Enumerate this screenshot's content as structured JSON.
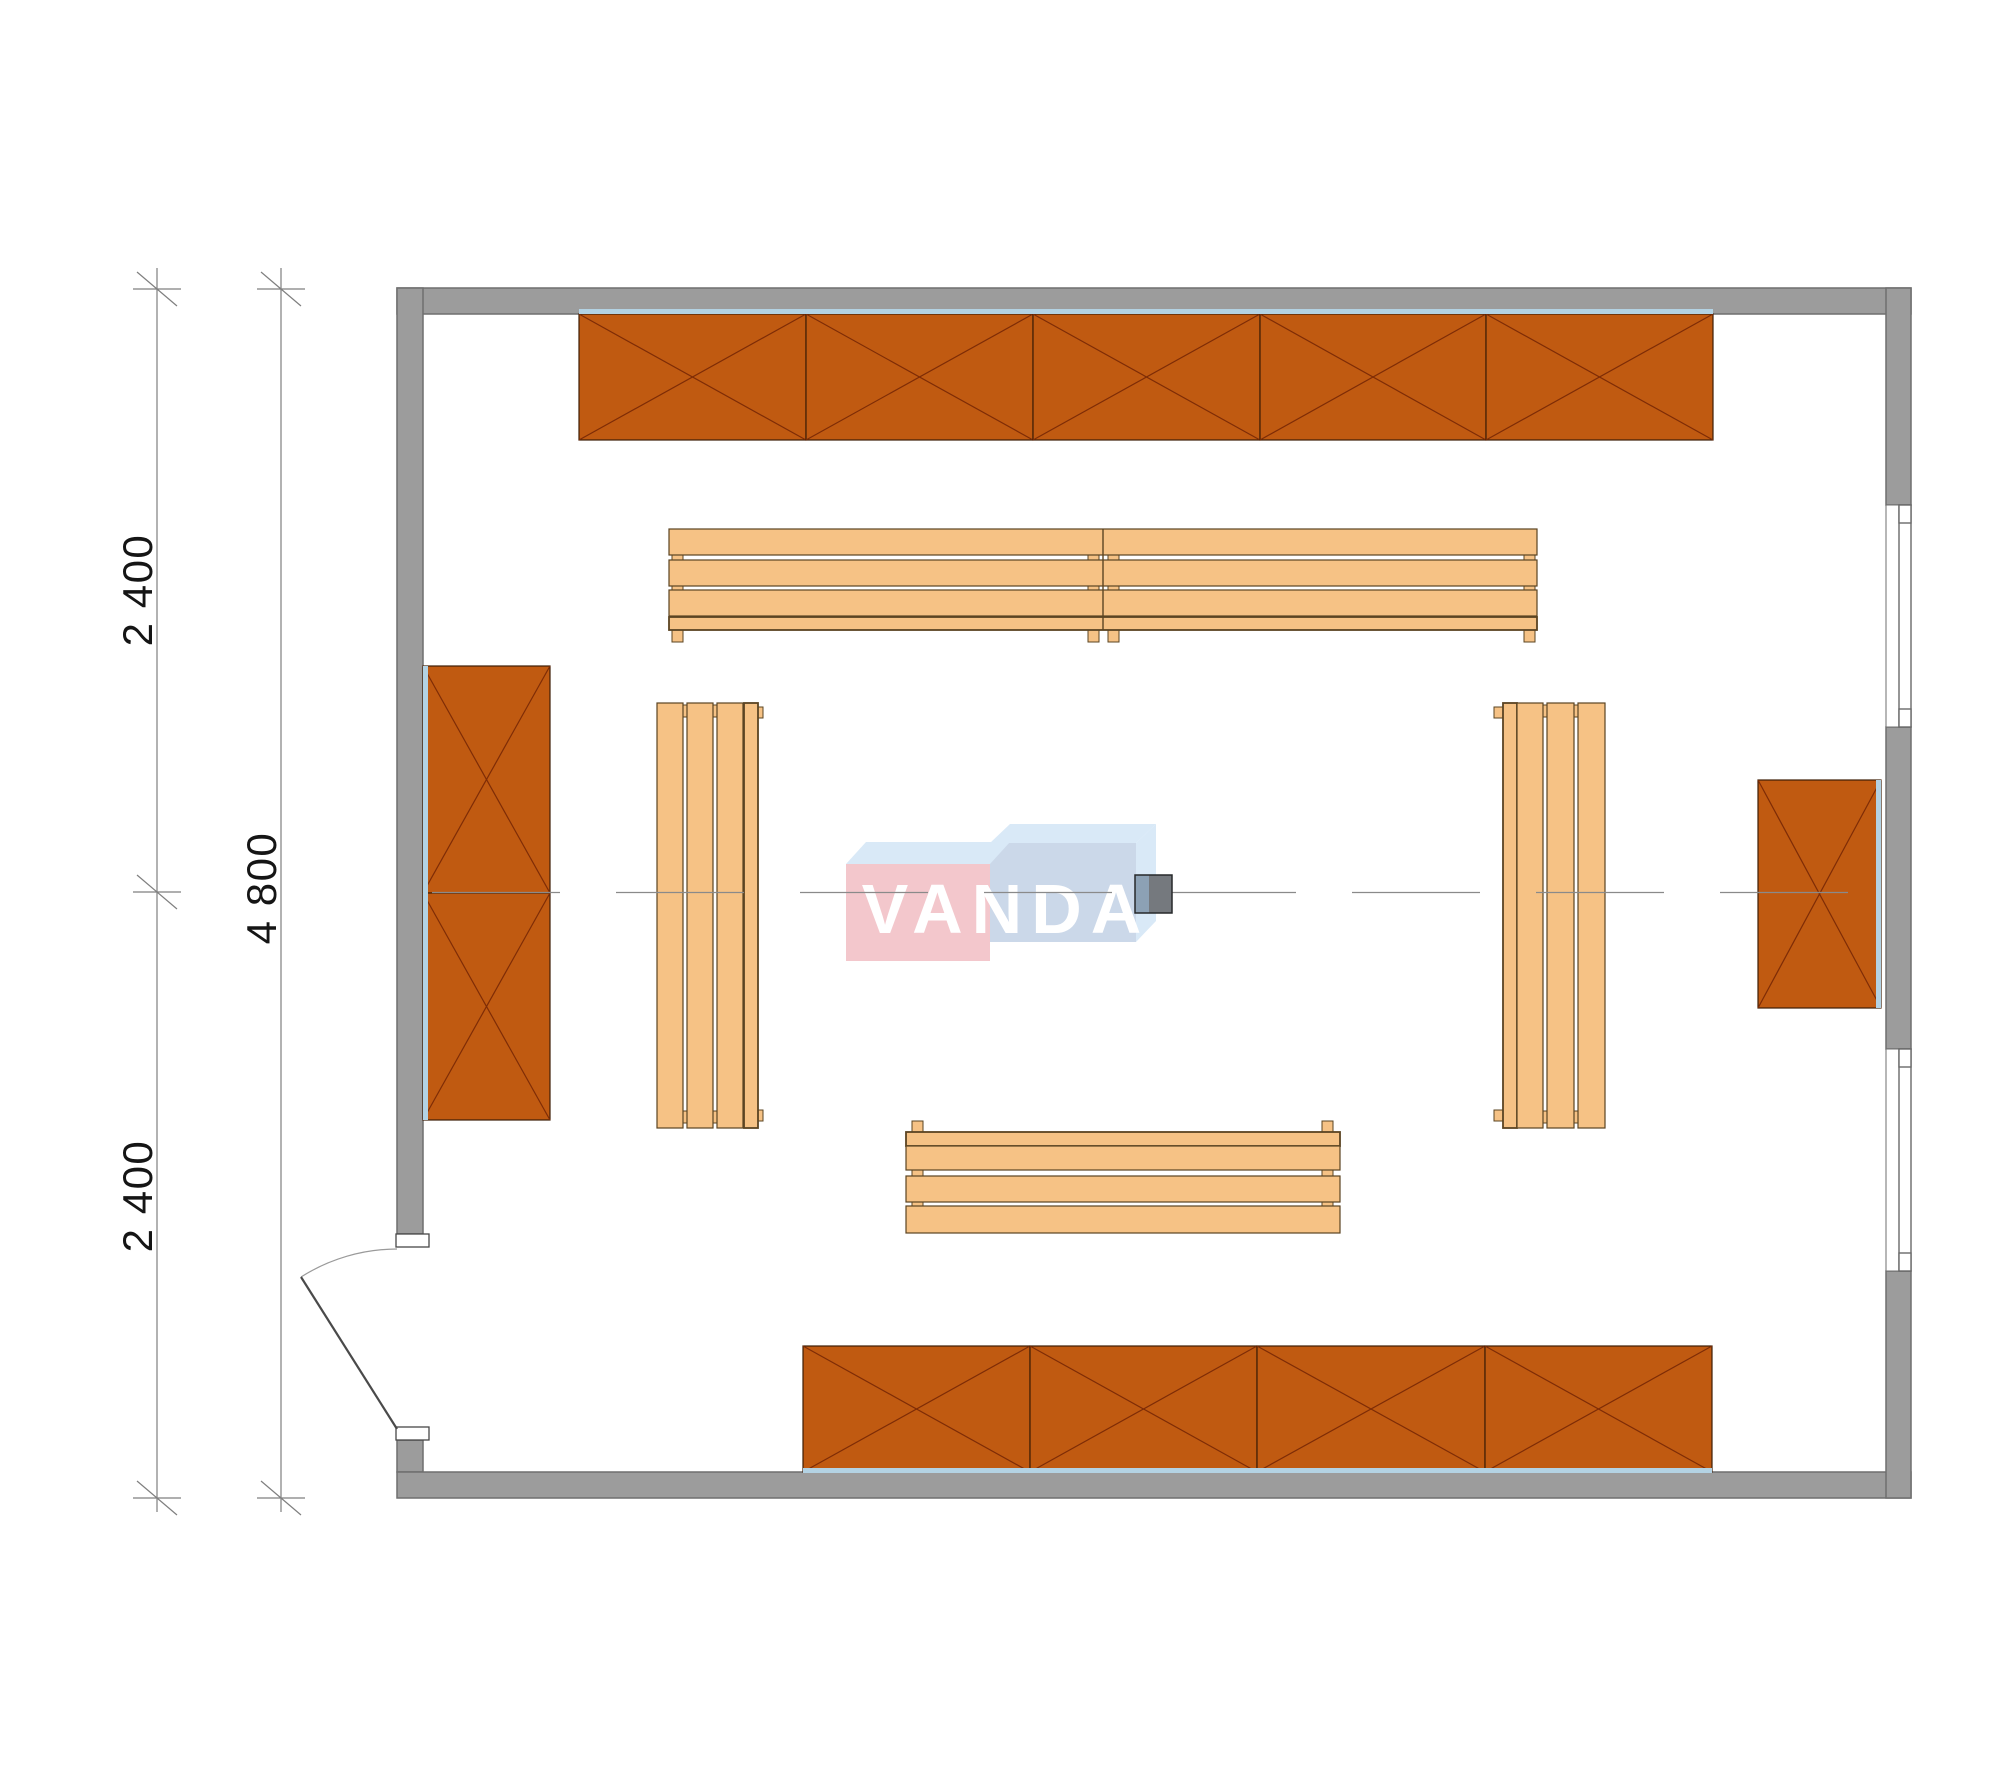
{
  "watermark": {
    "text": "VANDA"
  },
  "dimensions": {
    "top_left_label": "2 400",
    "bottom_left_label": "2 400",
    "overall_left_label": "4 800"
  },
  "plan": {
    "openings": {
      "windows": 2,
      "doors": 1
    },
    "furniture": {
      "wall_cabinet_segments": {
        "top": 5,
        "bottom": 4,
        "left": 2,
        "right": 1
      },
      "benches": {
        "top_pair": 2,
        "bottom": 1,
        "left": 1,
        "right": 1
      }
    }
  },
  "colors": {
    "wall-fill": "#9c9c9c",
    "wall-stroke": "#6f6f6f",
    "cabinet-fill": "#c05a11",
    "cabinet-stroke": "#3d1d05",
    "cabinet-x": "#7e2c06",
    "bench-fill": "#f6c285",
    "bench-stroke": "#5b4422",
    "finish-line": "#b3d2e3",
    "dim-line": "#7f7f7f",
    "wm-pink": "#f3c7cc",
    "wm-blue": "#cbd8e9",
    "wm-light": "#d9e9f7",
    "column-left": "#8ca1b5",
    "column-right": "#75797e"
  }
}
